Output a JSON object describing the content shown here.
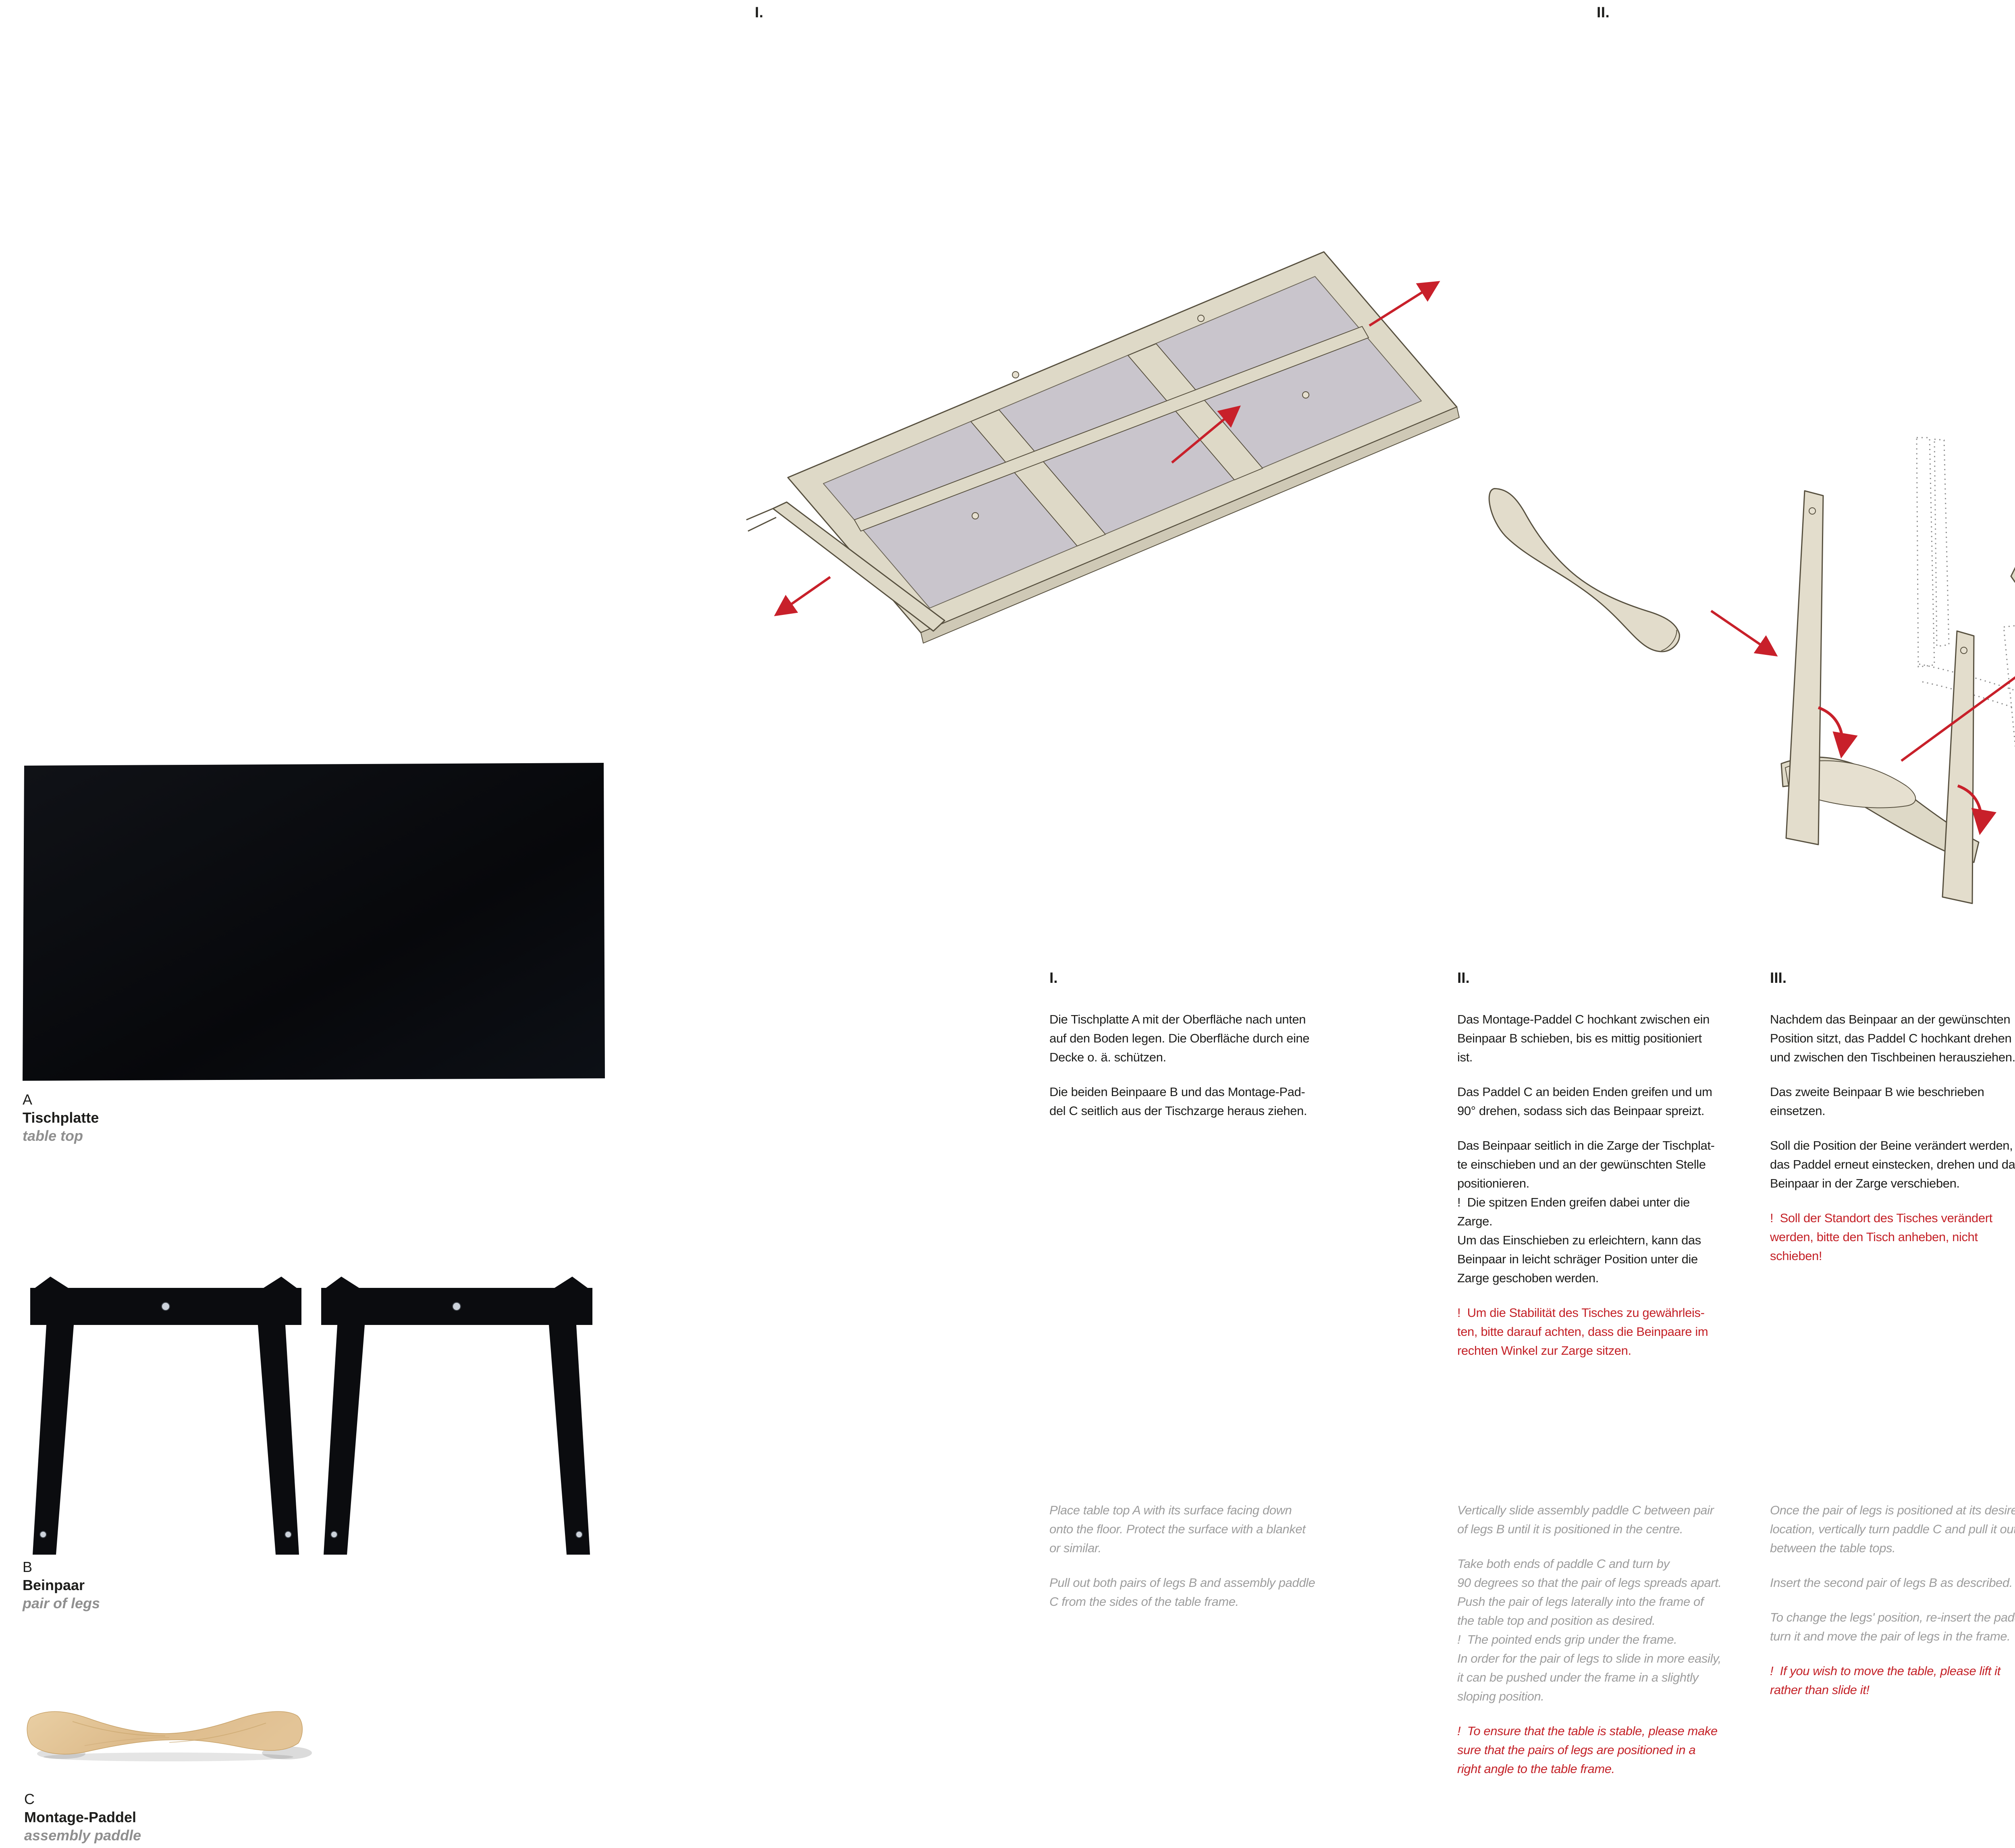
{
  "page": {
    "background": "#ffffff"
  },
  "colors": {
    "text": "#1d1d1b",
    "english_gray": "#9d9d9d",
    "warning_red": "#c42127",
    "arrow_red": "#c8202a",
    "wood_outline": "#57503f",
    "wood_fill": "#ded9c7",
    "panel_gray": "#c9c5cc",
    "photo_black": "#0b0d12",
    "paddle_wood": "#ddba8a"
  },
  "steps": [
    {
      "label": "I.",
      "de": [
        "Die Tischplatte A mit der Oberfläche nach unten\nauf den Boden legen. Die Oberfläche durch eine\nDecke o. ä. schützen.",
        "Die beiden Beinpaare B und das Montage-Pad-\ndel C seitlich aus der Tischzarge heraus ziehen."
      ],
      "en": [
        "Place table top A with its surface facing down\nonto the floor. Protect the surface with a blanket\nor similar.",
        "Pull out both pairs of legs B and assembly paddle\nC from the sides of the table frame."
      ]
    },
    {
      "label": "II.",
      "de": [
        "Das Montage-Paddel C hochkant zwischen ein\nBeinpaar B schieben, bis es mittig positioniert\nist.",
        "Das Paddel C an beiden Enden greifen und um\n90° drehen, sodass sich das Beinpaar spreizt.",
        "Das Beinpaar seitlich in die Zarge der Tischplat-\nte einschieben und an der gewünschten Stelle\npositionieren.\n!  Die spitzen Enden greifen dabei unter die\nZarge.\nUm das Einschieben zu erleichtern, kann das\nBeinpaar in leicht schräger Position unter die\nZarge geschoben werden."
      ],
      "de_warning": "!  Um die Stabilität des Tisches zu gewährleis-\nten, bitte darauf achten, dass die Beinpaare im\nrechten Winkel zur Zarge sitzen.",
      "en": [
        "Vertically slide assembly paddle C between pair\nof legs B until it is positioned in the centre.",
        "Take both ends of paddle C and turn by\n90 degrees so that the pair of legs spreads apart.\nPush the pair of legs laterally into the frame of\nthe table top and position as desired.\n!  The pointed ends grip under the frame.\nIn order for the pair of legs to slide in more easily,\nit can be pushed under the frame in a slightly\nsloping position."
      ],
      "en_warning": "!  To ensure that the table is stable, please make\nsure that the pairs of legs are positioned in a\nright angle to the table frame."
    },
    {
      "label": "III.",
      "de": [
        "Nachdem das Beinpaar an der gewünschten\nPosition sitzt, das Paddel C hochkant drehen\nund zwischen den Tischbeinen herausziehen.",
        "Das zweite Beinpaar B wie beschrieben\neinsetzen.",
        "Soll die Position der Beine verändert werden,\ndas Paddel erneut einstecken, drehen und das\nBeinpaar in der Zarge verschieben."
      ],
      "de_warning": "!  Soll der Standort des Tisches verändert\nwerden, bitte den Tisch anheben, nicht\nschieben!",
      "en": [
        "Once the pair of legs is positioned at its desired\nlocation, vertically turn paddle C and pull it out\nbetween the table tops.",
        "Insert the second pair of legs B as described.",
        "To change the legs' position, re-insert the paddle,\nturn it and move the pair of legs in the frame."
      ],
      "en_warning": "!  If you wish to move the table, please lift it\nrather than slide it!"
    }
  ],
  "components": [
    {
      "letter": "A",
      "name_de": "Tischplatte",
      "name_en": "table top"
    },
    {
      "letter": "B",
      "name_de": "Beinpaar",
      "name_en": "pair of legs"
    },
    {
      "letter": "C",
      "name_de": "Montage-Paddel",
      "name_en": "assembly paddle"
    }
  ]
}
